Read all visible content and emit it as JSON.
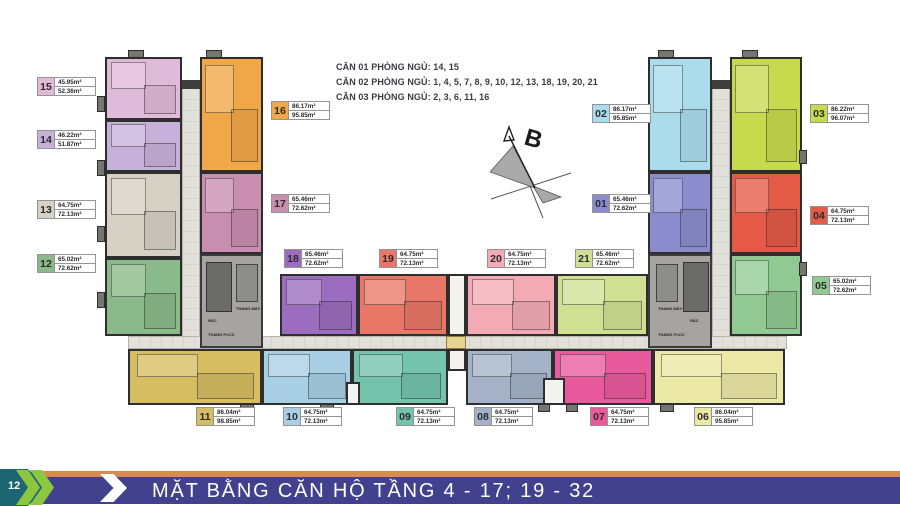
{
  "legend": {
    "lines": [
      "CĂN 01 PHÒNG NGỦ: 14, 15",
      "CĂN 02 PHÒNG NGỦ: 1, 4, 5, 7, 8, 9, 10, 12, 13, 18, 19, 20, 21",
      "CĂN 03 PHÒNG NGỦ: 2, 3, 6, 11, 16"
    ]
  },
  "compass": {
    "label": "B"
  },
  "core": {
    "elevator_label": "THANG MÁY",
    "trash_label": "RÁC",
    "stair_label": "THANG PCCC"
  },
  "units": [
    {
      "id": "01",
      "area1": "65.46m²",
      "area2": "72.62m²",
      "color": "#8b8ccd"
    },
    {
      "id": "02",
      "area1": "86.17m²",
      "area2": "95.85m²",
      "color": "#aadcec"
    },
    {
      "id": "03",
      "area1": "86.22m²",
      "area2": "96.07m²",
      "color": "#c6da4d"
    },
    {
      "id": "04",
      "area1": "64.75m²",
      "area2": "72.13m²",
      "color": "#e45a47"
    },
    {
      "id": "05",
      "area1": "65.02m²",
      "area2": "72.62m²",
      "color": "#90c992"
    },
    {
      "id": "06",
      "area1": "86.04m²",
      "area2": "95.85m²",
      "color": "#ece8a6"
    },
    {
      "id": "07",
      "area1": "64.75m²",
      "area2": "72.13m²",
      "color": "#e85a9c"
    },
    {
      "id": "08",
      "area1": "64.75m²",
      "area2": "72.13m²",
      "color": "#a3b2c6"
    },
    {
      "id": "09",
      "area1": "64.75m²",
      "area2": "72.13m²",
      "color": "#74c3ab"
    },
    {
      "id": "10",
      "area1": "64.75m²",
      "area2": "72.13m²",
      "color": "#a8cfe4"
    },
    {
      "id": "11",
      "area1": "86.04m²",
      "area2": "98.85m²",
      "color": "#d6bd62"
    },
    {
      "id": "12",
      "area1": "65.02m²",
      "area2": "72.62m²",
      "color": "#8aba8a"
    },
    {
      "id": "13",
      "area1": "64.75m²",
      "area2": "72.13m²",
      "color": "#d6d0c5"
    },
    {
      "id": "14",
      "area1": "46.22m²",
      "area2": "51.87m²",
      "color": "#c7b1da"
    },
    {
      "id": "15",
      "area1": "45.95m²",
      "area2": "52.36m²",
      "color": "#e0bad9"
    },
    {
      "id": "16",
      "area1": "86.17m²",
      "area2": "95.85m²",
      "color": "#f0a747"
    },
    {
      "id": "17",
      "area1": "65.46m²",
      "area2": "72.62m²",
      "color": "#c98db0"
    },
    {
      "id": "18",
      "area1": "65.46m²",
      "area2": "72.62m²",
      "color": "#9c6cbe"
    },
    {
      "id": "19",
      "area1": "64.75m²",
      "area2": "72.13m²",
      "color": "#e97768"
    },
    {
      "id": "20",
      "area1": "64.75m²",
      "area2": "72.13m²",
      "color": "#f2abb5"
    },
    {
      "id": "21",
      "area1": "65.46m²",
      "area2": "72.62m²",
      "color": "#d0df92"
    }
  ],
  "footer": {
    "page_number": "12",
    "title": "MẶT BẰNG CĂN HỘ TẦNG 4 - 17; 19 - 32",
    "bar_color": "#41418e",
    "stripe_color": "#d98a4e",
    "chevron_color": "#8dc63f",
    "page_marker_color": "#1b6671"
  }
}
